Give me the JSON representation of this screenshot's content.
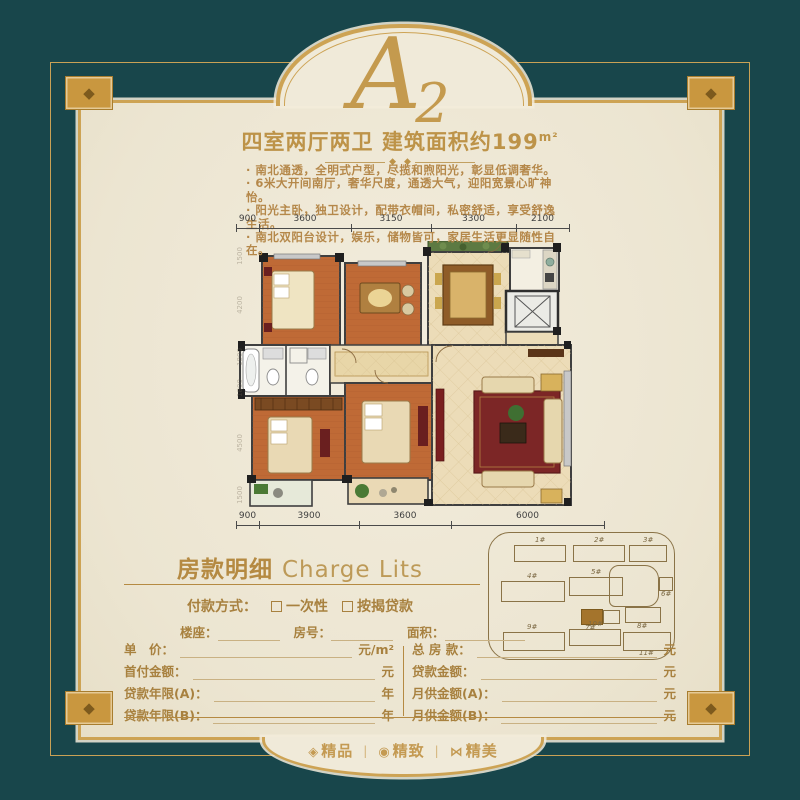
{
  "colors": {
    "teal": "#18464b",
    "gold": "#c9973f",
    "gold_line": "#cda354",
    "cream": "#f0ead9",
    "text_gold": "#b5884a",
    "plan_orange": "#bf6a36",
    "plan_beige": "#ecdcb8",
    "rug_red": "#7c2626"
  },
  "header": {
    "plan_letter": "A",
    "plan_number": "2",
    "subtitle": "四室两厅两卫 建筑面积约199",
    "subtitle_unit": "m²",
    "divider_glyph": "◆",
    "bullets": [
      "· 南北通透，全明式户型，尽揽和煦阳光，彰显低调奢华。",
      "· 6米大开间南厅，奢华尺度，通透大气，迎阳宽景心旷神怡。",
      "· 阳光主卧，独卫设计，配带衣帽间，私密舒适，享受舒逸生活。",
      "· 南北双阳台设计，娱乐，储物皆可，家居生活更显随性自在。"
    ]
  },
  "floorplan": {
    "dims_top": [
      "900",
      "3600",
      "3150",
      "3300",
      "2100"
    ],
    "dims_bottom": [
      "900",
      "3900",
      "3600",
      "6000"
    ],
    "dims_left": [
      "1500",
      "4200",
      "1800",
      "1800",
      "4500",
      "1500"
    ]
  },
  "siteplan": {
    "buildings": [
      "1#",
      "2#",
      "3#",
      "4#",
      "5#",
      "6#",
      "7#",
      "8#",
      "9#",
      "10#",
      "11#"
    ],
    "highlighted": "7#"
  },
  "form": {
    "title_cn": "房款明细",
    "title_en": "Charge Lits",
    "payment_label": "付款方式：",
    "payment_options": [
      "一次性",
      "按揭贷款"
    ],
    "info_fields": [
      "楼座：",
      "房号：",
      "面积："
    ],
    "left_rows": [
      {
        "label": "单　价：",
        "suffix": "元/m²"
      },
      {
        "label": "首付金额：",
        "suffix": "元"
      },
      {
        "label": "贷款年限(A)：",
        "suffix": "年"
      },
      {
        "label": "贷款年限(B)：",
        "suffix": "年"
      }
    ],
    "right_rows": [
      {
        "label": "总 房 款：",
        "suffix": "元"
      },
      {
        "label": "贷款金额：",
        "suffix": "元"
      },
      {
        "label": "月供金额(A)：",
        "suffix": "元"
      },
      {
        "label": "月供金额(B)：",
        "suffix": "元"
      }
    ]
  },
  "footer": {
    "separator": "|",
    "items": [
      {
        "icon": "◈",
        "label": "精品"
      },
      {
        "icon": "◉",
        "label": "精致"
      },
      {
        "icon": "⋈",
        "label": "精美"
      }
    ]
  }
}
